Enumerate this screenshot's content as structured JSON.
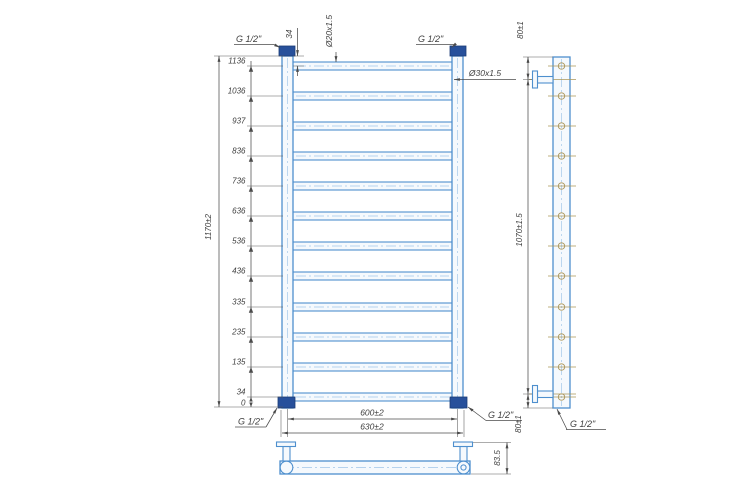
{
  "drawing": {
    "front_view": {
      "height_chain_labels": [
        "1136",
        "1036",
        "937",
        "836",
        "736",
        "636",
        "536",
        "436",
        "335",
        "235",
        "135",
        "34",
        "0"
      ],
      "overall_height": "1170±2",
      "top_rung_offset": "34",
      "rung_pipe_spec": "Ø20x1.5",
      "collector_pipe_spec": "Ø30x1.5",
      "connection_spacing": "600±2",
      "overall_width": "630±2",
      "thread_top_left": "G 1/2\"",
      "thread_top_right": "G 1/2\"",
      "thread_bottom_left": "G 1/2\"",
      "thread_bottom_right": "G 1/2\""
    },
    "side_view": {
      "top_bracket_offset": "80±1",
      "bracket_spacing": "1070±1.5",
      "bottom_bracket_offset": "80±1",
      "thread_bottom": "G 1/2\""
    },
    "bottom_view": {
      "bracket_depth": "83.5"
    },
    "colors": {
      "pipe_outline": "#4e8fce",
      "pipe_fill": "#f5f9fd",
      "fitting_fill": "#27509b",
      "centerline_blue": "#b5d2ee",
      "hole_marker_tan": "#ab9659",
      "dimension_line": "#4b4b4b",
      "text": "#3e3e3e",
      "background": "#ffffff"
    }
  }
}
